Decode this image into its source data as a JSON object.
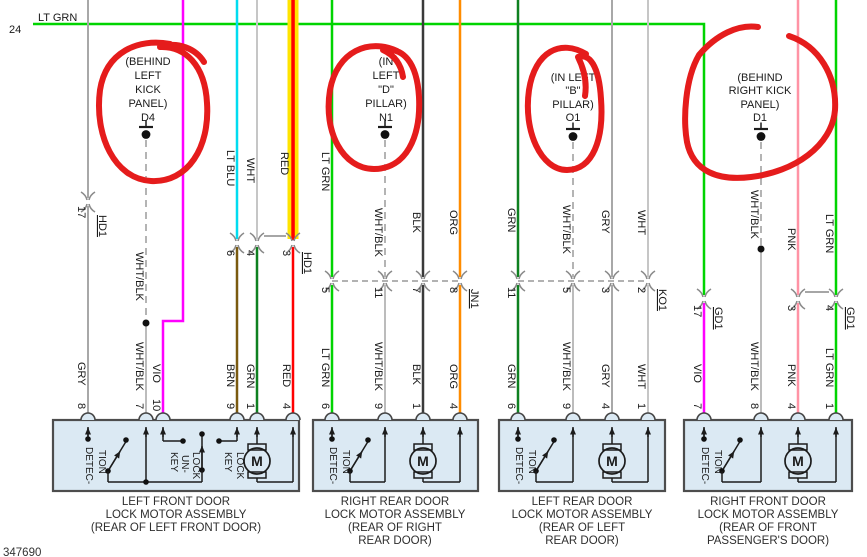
{
  "diagram": {
    "page_ref": "24",
    "figure_number": "347690",
    "bus_wire_label": "LT GRN"
  },
  "labels": {
    "lt_grn": "LT GRN",
    "lt_blu": "LT BLU",
    "wht": "WHT",
    "red": "RED",
    "wht_blk": "WHT/BLK",
    "blk": "BLK",
    "org": "ORG",
    "grn": "GRN",
    "gry": "GRY",
    "vio": "VIO",
    "brn": "BRN",
    "pnk": "PNK"
  },
  "pins": {
    "p1": "1",
    "p2": "2",
    "p3": "3",
    "p4": "4",
    "p5": "5",
    "p6": "6",
    "p7": "7",
    "p8": "8",
    "p9": "9",
    "p10": "10",
    "p11": "11",
    "p17": "17"
  },
  "connectors": {
    "hd1": "HD1",
    "jn1": "JN1",
    "ko1": "KO1",
    "gd1": "GD1"
  },
  "grounds": {
    "d4": {
      "line1": "(BEHIND",
      "line2": "LEFT",
      "line3": "KICK",
      "line4": "PANEL)",
      "code": "D4"
    },
    "n1": {
      "line1": "(IN",
      "line2": "LEFT",
      "line3": "\"D\"",
      "line4": "PILLAR)",
      "code": "N1"
    },
    "o1": {
      "line1": "(IN LEFT",
      "line2": "\"B\"",
      "line3": "PILLAR)",
      "code": "O1"
    },
    "d1": {
      "line1": "(BEHIND",
      "line2": "RIGHT KICK",
      "line3": "PANEL)",
      "code": "D1"
    }
  },
  "assemblies": {
    "box1": {
      "line1": "LEFT FRONT DOOR",
      "line2": "LOCK MOTOR ASSEMBLY",
      "line3": "(REAR OF LEFT FRONT DOOR)"
    },
    "box2": {
      "line1": "RIGHT REAR DOOR",
      "line2": "LOCK MOTOR ASSEMBLY",
      "line3": "(REAR OF RIGHT",
      "line4": "REAR DOOR)"
    },
    "box3": {
      "line1": "LEFT REAR DOOR",
      "line2": "LOCK MOTOR ASSEMBLY",
      "line3": "(REAR OF LEFT",
      "line4": "REAR DOOR)"
    },
    "box4": {
      "line1": "RIGHT FRONT DOOR",
      "line2": "LOCK MOTOR ASSEMBLY",
      "line3": "(REAR OF FRONT",
      "line4": "PASSENGER'S DOOR)"
    }
  },
  "internal": {
    "detec": "DETEC-",
    "tion": "TION",
    "key": "KEY",
    "un": "UN-",
    "lock": "LOCK",
    "motor": "M"
  },
  "colors": {
    "lt_grn": "#00d400",
    "grn": "#0f8020",
    "red": "#ff0000",
    "vio": "#ff00ff",
    "brn": "#7a5a10",
    "lt_blu": "#00dcf0",
    "org": "#ff8c00",
    "pnk": "#ff93a5",
    "blk_wire": "#3a3a3a",
    "gry": "#a8a8a8",
    "wht": "#c6c6c6",
    "wht_blk": "#b4b4b4",
    "highlight_yellow": "#ffe400",
    "hand_marker_red": "#e51c1c",
    "box_fill": "#dbe9f3"
  }
}
